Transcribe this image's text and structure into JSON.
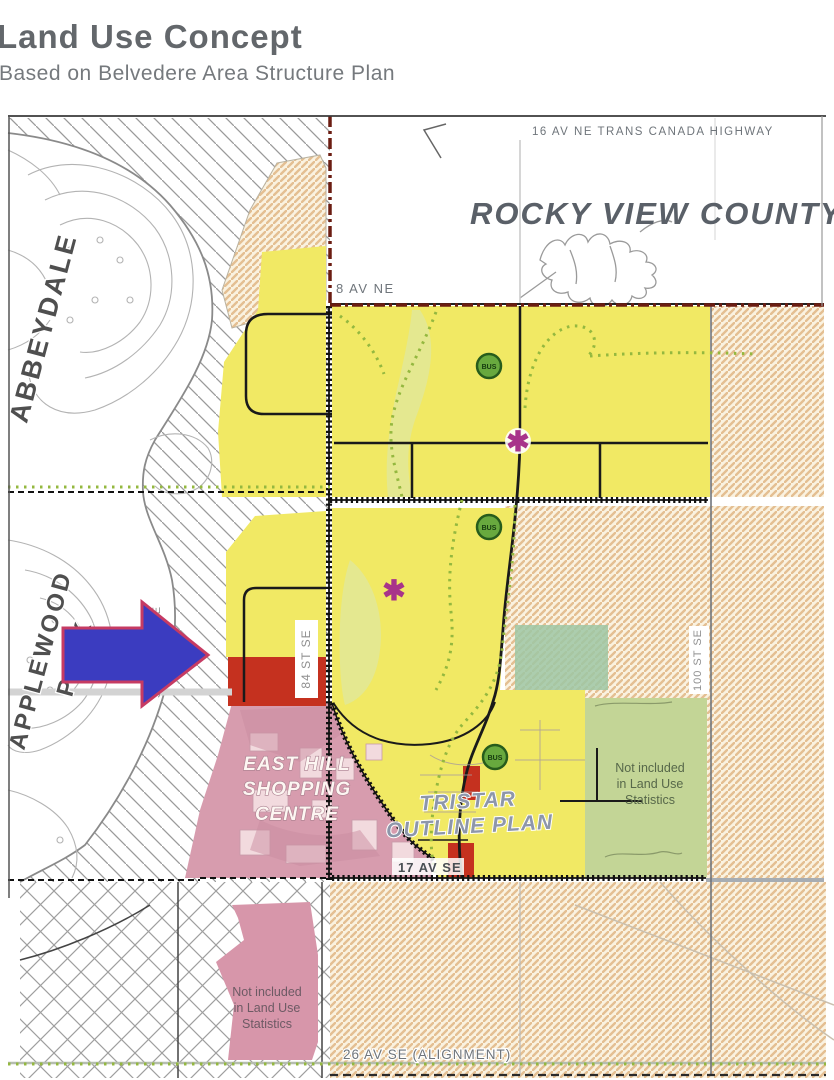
{
  "header": {
    "title": "Land Use Concept",
    "subtitle": "Based on Belvedere Area Structure Plan"
  },
  "map": {
    "labels": {
      "highway": "16 AV NE TRANS CANADA HIGHWAY",
      "county": "ROCKY VIEW COUNTY",
      "av8": "8 AV NE",
      "av17": "17 AV SE",
      "av26": "26 AV SE (ALIGNMENT)",
      "abbeydale": "ABBEYDALE",
      "applewood_line1": "APPLEWOOD",
      "applewood_line2": "PARK",
      "stoney": "STONEY TR SE",
      "st84": "84 ST SE",
      "st100": "100 ST SE",
      "east_hill": [
        "EAST HILL",
        "SHOPPING",
        "CENTRE"
      ],
      "tristar": [
        "TRISTAR",
        "OUTLINE PLAN"
      ],
      "not_included": [
        "Not included",
        "in Land Use",
        "Statistics"
      ],
      "bus": "BUS",
      "asterisk": "✱"
    },
    "colors": {
      "residential_yellow": "#f1e964",
      "county_tan_stripe": "#e4bf92",
      "commercial_pink": "#d79cae",
      "commercial_pink_south": "#d796aa",
      "school_red": "#c5311f",
      "open_green": "#c3d596",
      "teal_green": "#9dc7a4",
      "bus_green": "#68a93e",
      "asterisk_magenta": "#a8338a",
      "arrow_blue": "#3b3cc0",
      "arrow_outline": "#c63b63",
      "boundary_red": "#6b1d12"
    }
  }
}
